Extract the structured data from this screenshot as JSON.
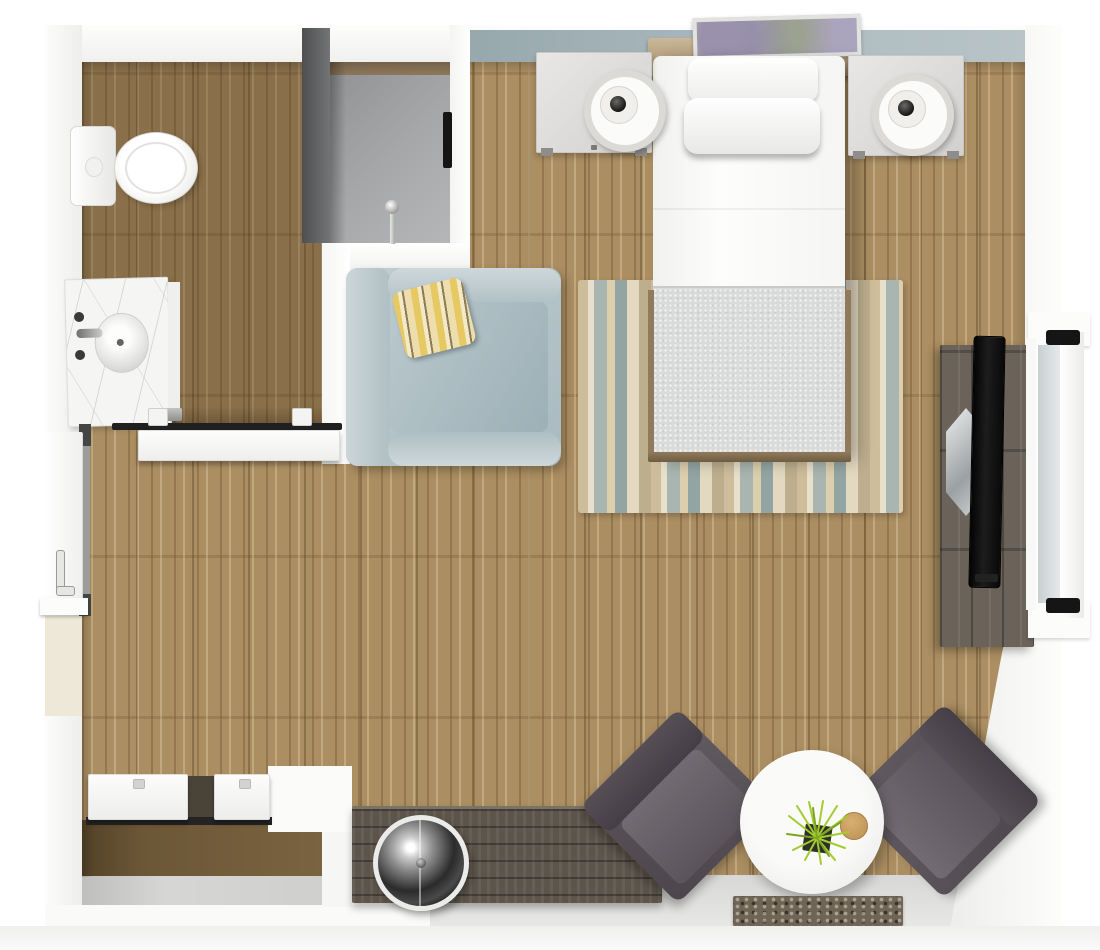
{
  "scene": {
    "type": "3d-floor-plan-render",
    "view": "top-down",
    "description": "Studio apartment 3D floor plan with bathroom, shower, closet, bed area and lounge seating"
  },
  "palette": {
    "wood": "#ab8e62",
    "entry_tile": "#e7e7e5",
    "accent": "#aebcc0",
    "shower_wall": "#727476",
    "chair_blue": "#a9bac0",
    "pillow_yellow": "#e7c963",
    "bed_white": "#fdfdfc",
    "blanket": "#d9dada",
    "rug_tan": "#cdbd9b",
    "rug_blue": "#93a5a3",
    "charcoal": "#4c464c",
    "table": "#f4f4f2",
    "plant": "#a2cc30",
    "dark_wood": "#6b635a",
    "tv": "#1d1d1d",
    "headboard": "#a08a69",
    "ivory": "#eee8d8"
  },
  "labels": {
    "floor_plan": "Studio apartment floor plan",
    "bathroom_floor": "Bathroom wood floor",
    "toilet": "Toilet",
    "vanity": "Vanity with sink",
    "shower": "Walk-in shower",
    "towel_bar": "Towel bar",
    "barn_door": "Bathroom sliding door",
    "entry_door": "Entry door",
    "armchair": "Light blue armchair",
    "throw_pillow": "Yellow striped throw pillow",
    "headboard": "Wood headboard",
    "artwork": "Framed artwork",
    "bed": "Bed with white linens and gray blanket",
    "nightstand_left": "Left nightstand",
    "nightstand_right": "Right nightstand",
    "lamp_left": "Left table lamp",
    "lamp_right": "Right table lamp",
    "rug": "Striped area rug",
    "tv_console": "TV console",
    "tv": "Flat screen TV",
    "window": "Window",
    "lounge_left": "Charcoal lounge chair",
    "lounge_right": "Charcoal lounge chair",
    "side_table": "Round side table",
    "plant": "Grass plant",
    "media_bench": "Rustic wood bench",
    "sphere_lamp": "Chrome sphere lamp",
    "doormat": "Entry doormat",
    "closet": "Closet with sliding doors",
    "accent_wall": "Blue-gray accent wall"
  }
}
